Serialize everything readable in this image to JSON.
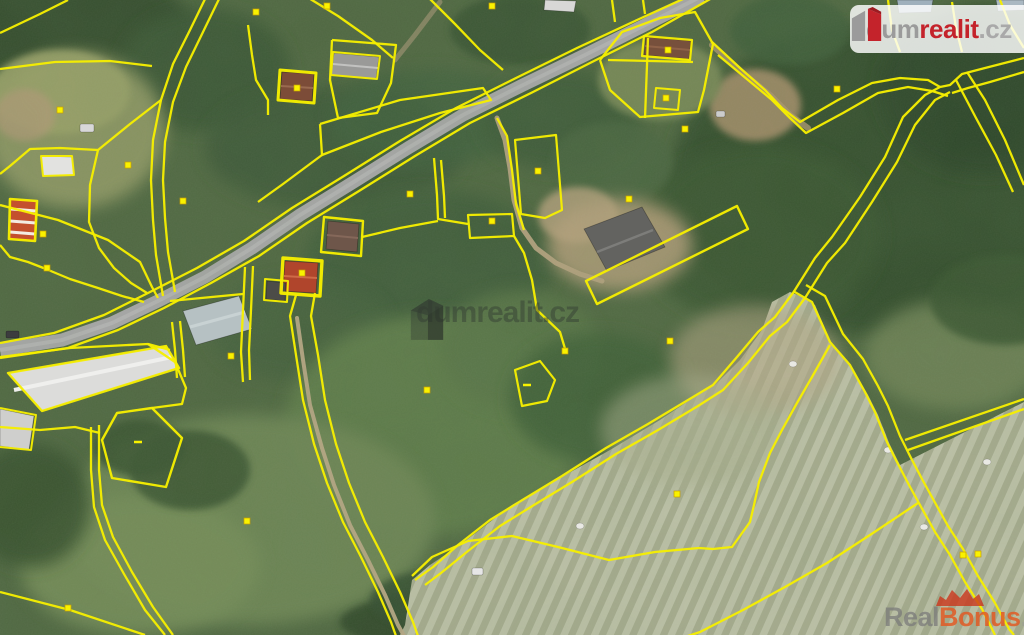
{
  "overlays": {
    "center_watermark": {
      "text": "dumrealit.cz"
    },
    "logo": {
      "dum": "dum",
      "realit": "realit",
      "cz": ".cz"
    },
    "bottom_watermark": {
      "real": "Real",
      "bonus": "Bonus",
      "cz": ".cz"
    }
  },
  "colors": {
    "parcel_yellow": "#f6ee00",
    "marker_yellow": "#f9f200",
    "road_gray": "#a6a6a6",
    "logo_red": "#c4232b",
    "bonus_orange": "#e05a25",
    "field_light": "#b3b89a",
    "base_green": "#4f6741"
  },
  "map": {
    "width": 1024,
    "height": 635,
    "terrain": [
      {
        "cx": 60,
        "cy": 25,
        "rx": 130,
        "ry": 60,
        "f": "#344d2f",
        "o": 1
      },
      {
        "cx": 205,
        "cy": 70,
        "rx": 85,
        "ry": 62,
        "f": "#3a5634",
        "o": 0.9
      },
      {
        "cx": 75,
        "cy": 130,
        "rx": 90,
        "ry": 78,
        "f": "#8d9663",
        "o": 0.95
      },
      {
        "cx": 60,
        "cy": 92,
        "rx": 70,
        "ry": 42,
        "f": "#98a067",
        "o": 0.9
      },
      {
        "cx": 25,
        "cy": 115,
        "rx": 30,
        "ry": 26,
        "f": "#b09a76",
        "o": 0.75
      },
      {
        "cx": 520,
        "cy": 30,
        "rx": 70,
        "ry": 35,
        "f": "#375233",
        "o": 0.85
      },
      {
        "cx": 335,
        "cy": 148,
        "rx": 130,
        "ry": 62,
        "f": "#3c5838",
        "o": 0.85
      },
      {
        "cx": 430,
        "cy": 118,
        "rx": 100,
        "ry": 48,
        "f": "#41603c",
        "o": 0.8
      },
      {
        "cx": 430,
        "cy": 262,
        "rx": 125,
        "ry": 72,
        "f": "#3f5d3a",
        "o": 0.9
      },
      {
        "cx": 300,
        "cy": 330,
        "rx": 90,
        "ry": 52,
        "f": "#44613d",
        "o": 0.8
      },
      {
        "cx": 435,
        "cy": 425,
        "rx": 150,
        "ry": 110,
        "f": "#5d7a49",
        "o": 1
      },
      {
        "cx": 520,
        "cy": 350,
        "rx": 80,
        "ry": 60,
        "f": "#587547",
        "o": 0.9
      },
      {
        "cx": 250,
        "cy": 520,
        "rx": 185,
        "ry": 105,
        "f": "#6d8555",
        "o": 0.95
      },
      {
        "cx": 140,
        "cy": 565,
        "rx": 120,
        "ry": 70,
        "f": "#748c59",
        "o": 0.9
      },
      {
        "cx": 30,
        "cy": 505,
        "rx": 60,
        "ry": 62,
        "f": "#37512f",
        "o": 0.9
      },
      {
        "cx": 190,
        "cy": 470,
        "rx": 60,
        "ry": 40,
        "f": "#3b5533",
        "o": 0.85
      },
      {
        "cx": 540,
        "cy": 622,
        "rx": 200,
        "ry": 38,
        "f": "#31492c",
        "o": 0.9
      },
      {
        "cx": 455,
        "cy": 600,
        "rx": 85,
        "ry": 32,
        "f": "#355030",
        "o": 0.85
      },
      {
        "cx": 880,
        "cy": 180,
        "rx": 210,
        "ry": 155,
        "f": "#35502f",
        "o": 1
      },
      {
        "cx": 760,
        "cy": 235,
        "rx": 120,
        "ry": 90,
        "f": "#3a5733",
        "o": 0.9
      },
      {
        "cx": 985,
        "cy": 90,
        "rx": 105,
        "ry": 85,
        "f": "#2f472b",
        "o": 0.9
      },
      {
        "cx": 790,
        "cy": 30,
        "rx": 60,
        "ry": 35,
        "f": "#405e3a",
        "o": 0.8
      },
      {
        "cx": 560,
        "cy": 120,
        "rx": 80,
        "ry": 50,
        "f": "#3d5a37",
        "o": 0.85
      },
      {
        "cx": 612,
        "cy": 162,
        "rx": 60,
        "ry": 40,
        "f": "#486540",
        "o": 0.8
      },
      {
        "cx": 620,
        "cy": 245,
        "rx": 72,
        "ry": 46,
        "f": "#ac9a76",
        "o": 0.9
      },
      {
        "cx": 578,
        "cy": 215,
        "rx": 40,
        "ry": 28,
        "f": "#b5a17d",
        "o": 0.8
      },
      {
        "cx": 755,
        "cy": 105,
        "rx": 46,
        "ry": 36,
        "f": "#a8906c",
        "o": 0.85
      },
      {
        "cx": 660,
        "cy": 80,
        "rx": 62,
        "ry": 40,
        "f": "#7a8a58",
        "o": 0.9
      },
      {
        "cx": 955,
        "cy": 355,
        "rx": 90,
        "ry": 55,
        "f": "#6d8154",
        "o": 0.9
      },
      {
        "cx": 1005,
        "cy": 300,
        "rx": 75,
        "ry": 45,
        "f": "#3b5733",
        "o": 0.85
      },
      {
        "cx": 600,
        "cy": 398,
        "rx": 90,
        "ry": 65,
        "f": "#416038",
        "o": 0.9
      },
      {
        "cx": 140,
        "cy": 448,
        "rx": 45,
        "ry": 28,
        "f": "#3a5433",
        "o": 0.9
      }
    ],
    "field": {
      "pts": "512,505 560,478 610,450 660,420 690,400 715,385 740,360 762,330 772,302 790,292 800,296 815,305 832,345 852,368 868,395 878,415 890,445 900,465 1024,402 1024,635 400,635 405,625 412,580 430,565 460,545 490,522",
      "fill": "#b3b89a"
    },
    "field_tint": [
      {
        "cx": 755,
        "cy": 360,
        "rx": 85,
        "ry": 55,
        "f": "#b4a685",
        "o": 0.55
      },
      {
        "cx": 690,
        "cy": 430,
        "rx": 90,
        "ry": 55,
        "f": "#aaaf8e",
        "o": 0.5
      }
    ],
    "tracks": [
      {
        "d": "M297,318 L303,360 L310,405 L322,448 L334,485 L350,525 L368,560 L385,595 L398,625 L404,636",
        "c": "#b6a684",
        "w": 4,
        "o": 0.95
      },
      {
        "d": "M497,118 L505,140 L510,168 L514,200 L522,228 L536,248 L556,263 L580,274 L602,281",
        "c": "#b3a17e",
        "w": 5,
        "o": 0.95
      },
      {
        "d": "M712,45 L745,75 L770,95 L790,115 L808,128",
        "c": "#ab9670",
        "w": 6,
        "o": 0.8
      },
      {
        "d": "M440,2 L415,35 L395,60",
        "c": "#a99677",
        "w": 5,
        "o": 0.6
      }
    ],
    "road": {
      "d": "M702,-4 L645,25 L585,55 L523,85 L463,115 L408,148 L352,183 L300,215 L252,248 L205,277 L158,301 L112,323 L62,340 L0,350",
      "c": "#a6a6a6",
      "w": 13
    },
    "road_center": {
      "d": "M702,-4 L645,25 L585,55 L523,85 L463,115 L408,148 L352,183 L300,215 L252,248 L205,277 L158,301 L112,323 L62,340 L0,350",
      "c": "#bdbdbd",
      "w": 4,
      "o": 0.5
    },
    "parcel_lines": [
      "M694,-6 L637,20 L577,48 L516,78 L456,108 L400,141 L344,176 L292,208 L244,241 L197,268 L150,292 L104,315 L54,333 L0,343",
      "M712,-2 L652,32 L592,62 L531,93 L470,123 L415,156 L359,191 L307,223 L259,256 L211,283 L164,308 L118,330 L68,348 L0,358",
      "M0,33 L40,14 L68,0",
      "M206,-3 L190,30 L173,64 L161,100 L153,140 L151,180 L153,220 L156,255 L163,296",
      "M220,-3 L203,32 L186,67 L173,102 L165,142 L163,180 L165,218 L168,252 L175,292",
      "M0,69 L55,62 L110,61 L152,66",
      "M0,205 L58,220 L108,240 L140,262 L152,287 L158,298",
      "M161,100 L130,124 L98,150",
      "M98,150 L60,148 L30,149 L10,166 L0,174",
      "M0,245 L10,257 L28,262 L46,269 L70,279 L98,288 L122,296 L144,302",
      "M98,150 L90,185 L89,222 L99,248 L114,268 L131,283 L147,293",
      [
        "M41,156 L72,156 L74,175 L43,176 Z",
        2
      ],
      [
        "M10,199 L37,201 L35,241 L9,239 Z",
        2.6
      ],
      "M248,25 L252,55 L256,80 L268,100 L268,115",
      [
        "M280,70 L316,73 L314,103 L278,100 Z",
        3
      ],
      "M332,40 L396,45 L391,83 L377,113 L338,118 L330,80 L332,40",
      [
        "M333,52 L380,56 L377,79 L331,75 Z",
        2
      ],
      "M320,124 L400,100 L483,88 L491,100 L440,113 L381,132 L322,155 L320,124",
      "M322,155 L283,184 L258,202",
      "M307,-3 L338,16 L372,40 L393,58",
      "M428,-3 L455,24 L480,50 L503,70",
      [
        "M515,140 L556,135 L562,210 L545,218 L521,214 Z",
        2.2
      ],
      "M497,118 L507,136 L512,170 L516,204 L524,230",
      [
        "M468,215 L512,214 L514,236 L470,238 Z",
        2.2
      ],
      "M434,158 L437,195 L438,219 L468,224",
      "M441,160 L444,196 L445,218",
      "M514,236 L524,253 L532,280 L537,310 L560,332 L566,352",
      "M362,237 L400,228 L438,221",
      [
        "M283,258 L322,261 L320,296 L281,293 Z",
        3.4
      ],
      [
        "M265,279 L288,281 L287,302 L264,300 Z",
        2
      ],
      [
        "M324,217 L363,221 L361,256 L321,252 Z",
        2.4
      ],
      "M253,266 L251,310 L249,350 L250,380",
      "M245,267 L243,310 L241,352 L243,382",
      "M170,301 L243,294",
      "M172,322 L175,350 L177,378",
      "M180,321 L183,350 L185,377",
      "M0,357 L70,348 L148,344 L170,350",
      "M148,344 L175,362 L186,388 L182,404 L152,408",
      "M0,427 L40,430 L75,427 L100,433",
      [
        "M8,373 L166,346 L179,368 L42,411 Z",
        2.4
      ],
      [
        "M0,408 L36,415 L31,450 L0,447",
        2
      ],
      [
        "M102,440 L117,413 L152,408 L182,438 L166,487 L112,478 Z",
        2.4
      ],
      "M99,425 L99,470 L102,505 L113,537 L132,572 L153,607 L173,635",
      "M91,427 L91,470 L94,507 L105,540 L124,574 L145,610 L165,635",
      "M0,592 L70,610 L145,635",
      "M296,295 L290,316 L296,355 L303,400 L314,444 L327,483 L343,522 L361,557 L378,592 L391,622 L396,636",
      "M315,293 L311,316 L318,355 L325,400 L336,444 L349,483 L365,522 L383,557 L400,592 L413,622 L418,636",
      "M830,345 L812,377 L797,403 L782,430 L770,453 L759,482 L754,505 L750,522 L732,547 L713,549 L699,548 L655,552 L609,560 L558,547 L512,536 L468,541 L432,557 L412,576",
      "M940,87 L925,95 L903,117 L885,157 L860,197 L832,237 L815,258 L793,293 L775,317 L758,332 L737,357 L713,385 L688,400 L648,424 L606,448 L562,476 L524,499 L490,520 L458,545 L433,567 L415,580",
      "M950,92 L935,100 L915,125 L897,162 L872,202 L845,243 L827,263 L805,298 L787,322 L770,336 L748,363 L723,390 L698,406 L658,430 L616,454 L572,482 L534,505 L500,526 L468,551 L441,573 L425,585",
      "M793,291 L812,302 L830,342 L850,365 L865,392 L875,412 L887,442 L897,462 L909,485 L920,505 L935,532 L950,555 L965,582 L982,609 L995,635",
      "M806,285 L825,296 L843,334 L863,359 L878,386 L888,406 L900,436 L910,456 L922,479 L933,499 L948,526 L963,549 L978,576 L995,603 L1009,629 L1014,635",
      "M905,440 L1024,399",
      "M908,450 L1024,409",
      "M918,503 L873,533 L827,563 L785,587 L743,610 L700,632 L688,636",
      "M1024,58 L985,68 L962,74 L950,85 L940,87",
      "M1024,72 L990,82 L968,88 L952,93",
      "M967,72 L985,100 L1005,140 L1024,185",
      "M956,80 L976,118 L996,155 L1013,192",
      "M600,60 L622,32 L660,18 L695,12 L713,44 L704,90 L698,112 L640,117 L610,90 L600,60",
      "M608,60 L693,62",
      "M648,38 L645,118",
      [
        "M656,88 L680,90 L678,110 L654,108 Z",
        2
      ],
      [
        "M644,36 L692,40 L690,60 L642,56 Z",
        2.2
      ],
      "M612,0 L615,22",
      "M643,0 L645,14",
      "M712,42 L740,68 L765,90 L782,108 L800,122 L838,100 L872,83 L900,78 L928,80 L940,87",
      "M718,55 L748,80 L772,100 L790,118 L806,133 L843,113 L878,93 L908,87 L932,91 L948,96",
      "M888,0 L892,30 L900,52",
      "M952,2 L956,28 L962,52",
      "M1000,0 L1010,25 L1024,48",
      [
        "M515,370 L540,361 L555,380 L547,401 L522,406 Z",
        2.2
      ],
      [
        "M586,281 L737,206 L748,229 L597,304 Z",
        2.4
      ]
    ],
    "buildings": [
      {
        "n": "small-white-building",
        "pts": "41,156 72,157 74,175 43,176",
        "f": "#e2e2e0",
        "lines": []
      },
      {
        "n": "striped-roof-house",
        "pts": "11,199 37,201 35,241 9,239",
        "f": "#c4502e",
        "lines": [
          {
            "d": "M11,209 L36,211",
            "c": "#f3ece2",
            "w": 3
          },
          {
            "d": "M10,221 L36,223",
            "c": "#f3ece2",
            "w": 3
          },
          {
            "d": "M10,232 L35,234",
            "c": "#f3ece2",
            "w": 3
          }
        ]
      },
      {
        "n": "house-brown-roof",
        "pts": "282,72 314,74 312,101 280,99",
        "f": "#7c4c38",
        "lines": [
          {
            "d": "M281,86 L313,88",
            "c": "#9a6a50",
            "w": 2
          }
        ]
      },
      {
        "n": "gray-gabled-building",
        "pts": "334,53 379,57 376,79 331,75",
        "f": "#9a9a98",
        "lines": [
          {
            "d": "M333,64 L378,68",
            "c": "#c2c2c0",
            "w": 2
          }
        ]
      },
      {
        "n": "house-topright",
        "pts": "646,37 691,41 689,59 644,55",
        "f": "#77503c",
        "lines": [
          {
            "d": "M645,46 L690,50",
            "c": "#8f6248",
            "w": 2
          }
        ]
      },
      {
        "n": "house-dark-mid",
        "pts": "328,221 359,224 357,252 326,249",
        "f": "#6e564a",
        "lines": [
          {
            "d": "M327,235 L358,238",
            "c": "#85685a",
            "w": 2
          }
        ]
      },
      {
        "n": "red-roof-house",
        "pts": "285,261 318,263 316,293 283,291",
        "f": "#b0452c",
        "lines": [
          {
            "d": "M284,276 L317,278",
            "c": "#cf6a47",
            "w": 2
          }
        ]
      },
      {
        "n": "dark-shed",
        "pts": "267,281 286,283 285,301 266,299",
        "f": "#4c4c48",
        "lines": []
      },
      {
        "n": "warehouse-flat-roof",
        "pts": "183,311 239,296 252,329 196,345",
        "f": "#b6c1c3",
        "lines": [
          {
            "d": "M190,327 L245,312",
            "c": "#c8d2d3",
            "w": 3
          }
        ]
      },
      {
        "n": "long-white-building",
        "pts": "8,373 166,346 179,368 42,411",
        "f": "#dcdcda",
        "lines": [
          {
            "d": "M14,390 L172,357",
            "c": "#efefed",
            "w": 4
          }
        ]
      },
      {
        "n": "annex-building",
        "pts": "0,409 34,416 29,450 0,446",
        "f": "#cfcfcd",
        "lines": []
      },
      {
        "n": "barn-dark-roof",
        "pts": "584,229 642,207 665,247 607,271",
        "f": "#636360",
        "lines": [
          {
            "d": "M597,252 L653,230",
            "c": "#7d7d7a",
            "w": 2.5
          }
        ]
      },
      {
        "n": "roof-top-edge-1",
        "pts": "897,0 933,0 931,12 899,13",
        "f": "#9fb0bc",
        "lines": []
      },
      {
        "n": "roof-top-edge-2",
        "pts": "996,0 1024,0 1024,10 998,11",
        "f": "#aab8c2",
        "lines": []
      },
      {
        "n": "roof-top-edge-3",
        "pts": "545,0 576,1 574,12 544,10",
        "f": "#d8d8d6",
        "lines": []
      }
    ],
    "vehicles": [
      {
        "x": 80,
        "y": 124,
        "w": 14,
        "h": 8,
        "f": "#d8d8d8"
      },
      {
        "x": 472,
        "y": 568,
        "w": 11,
        "h": 7,
        "f": "#e6e6e6"
      },
      {
        "x": 716,
        "y": 111,
        "w": 9,
        "h": 6,
        "f": "#cccccc"
      },
      {
        "x": 6,
        "y": 331,
        "w": 13,
        "h": 7,
        "f": "#3c3c3e"
      }
    ],
    "bales": [
      [
        793,
        364
      ],
      [
        888,
        450
      ],
      [
        987,
        462
      ],
      [
        924,
        527
      ],
      [
        580,
        526
      ]
    ],
    "markers": [
      [
        327,
        6
      ],
      [
        492,
        6
      ],
      [
        256,
        12
      ],
      [
        60,
        110
      ],
      [
        128,
        165
      ],
      [
        183,
        201
      ],
      [
        43,
        234
      ],
      [
        47,
        268
      ],
      [
        410,
        194
      ],
      [
        492,
        221
      ],
      [
        538,
        171
      ],
      [
        302,
        273
      ],
      [
        297,
        88
      ],
      [
        668,
        50
      ],
      [
        666,
        98
      ],
      [
        837,
        89
      ],
      [
        685,
        129
      ],
      [
        629,
        199
      ],
      [
        231,
        356
      ],
      [
        427,
        390
      ],
      [
        247,
        521
      ],
      [
        68,
        608
      ],
      [
        565,
        351
      ],
      [
        670,
        341
      ],
      [
        677,
        494
      ],
      [
        963,
        555
      ],
      [
        978,
        554
      ]
    ],
    "dashes": [
      [
        527,
        385
      ],
      [
        138,
        442
      ]
    ]
  }
}
